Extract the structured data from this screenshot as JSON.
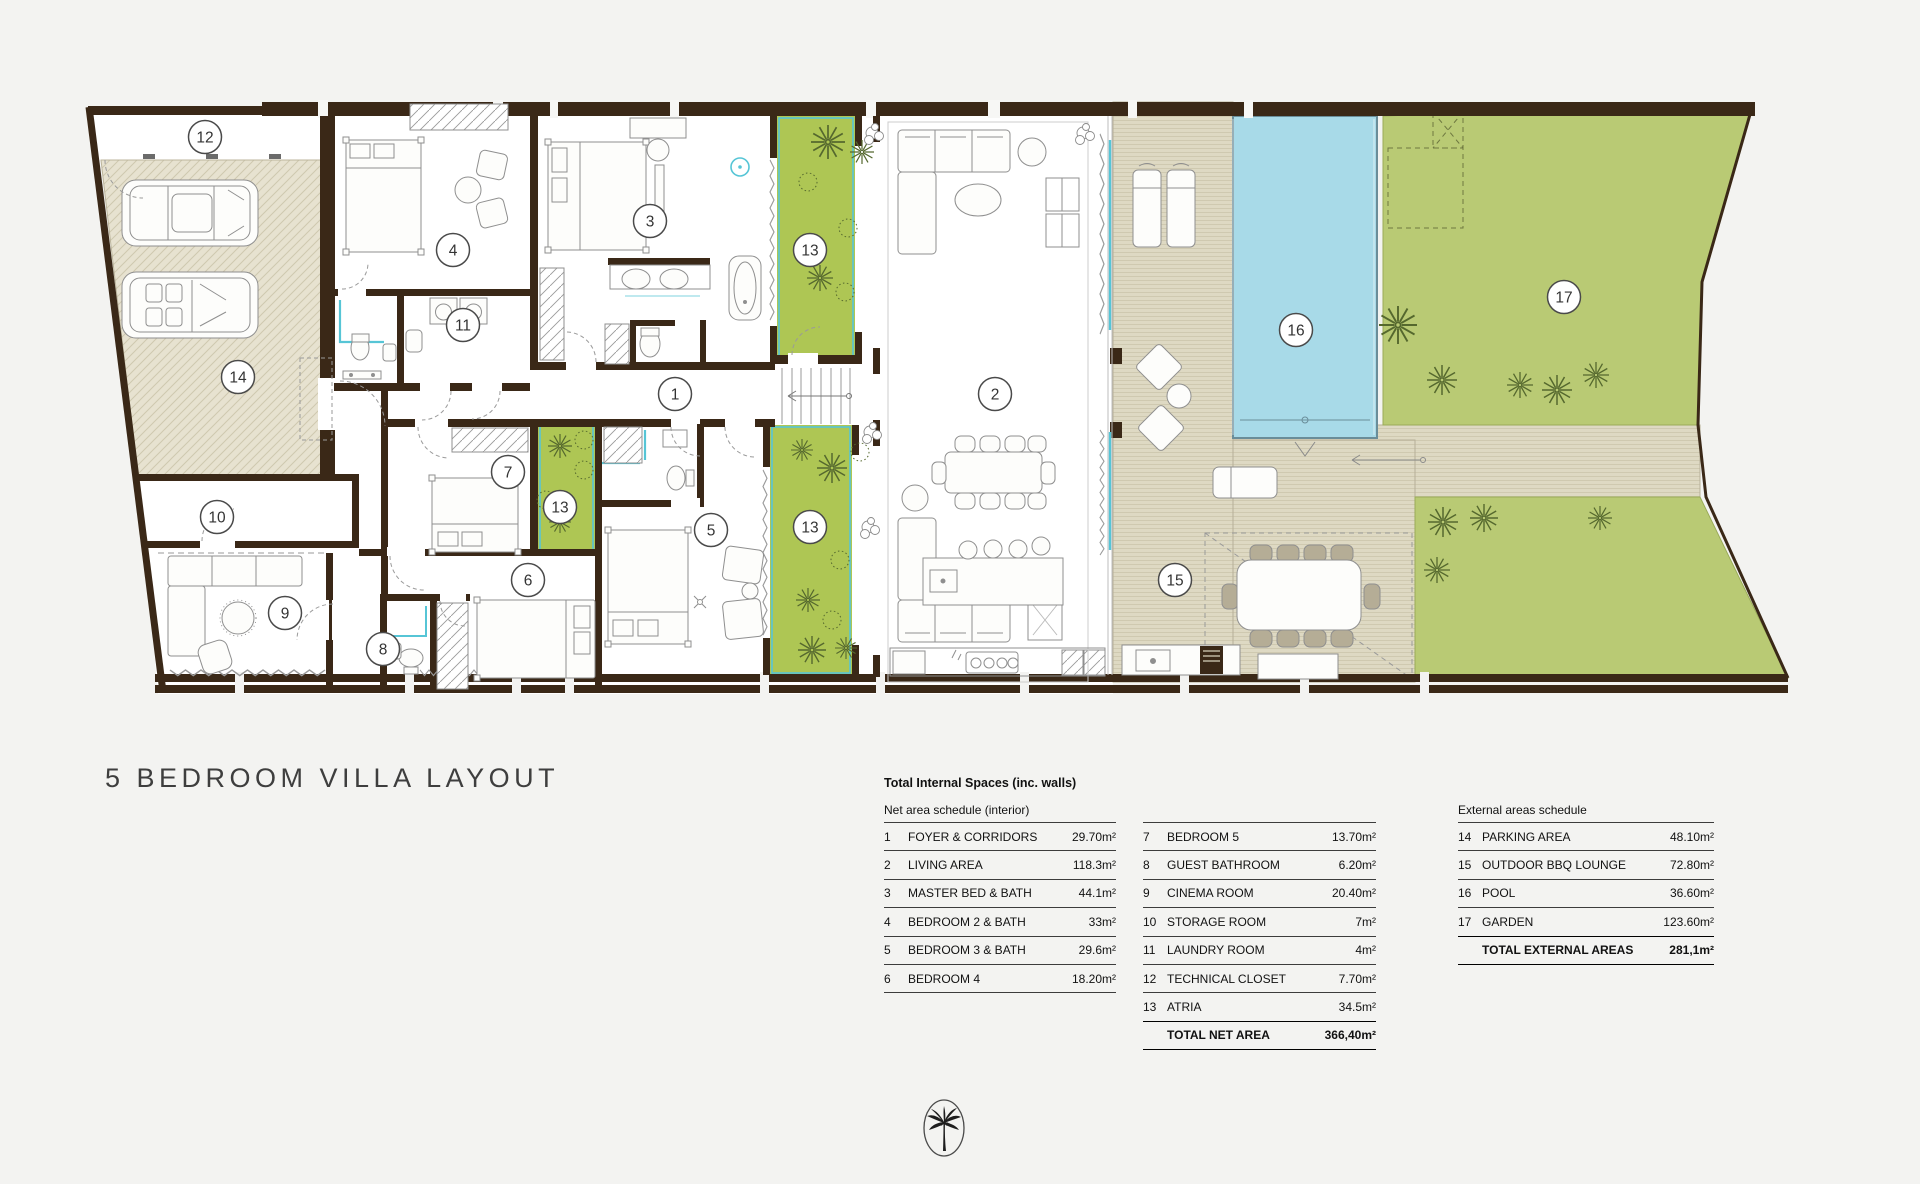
{
  "title": "5 BEDROOM VILLA LAYOUT",
  "logo": {
    "icon": "palm-tree-icon"
  },
  "colors": {
    "wall": "#3a2817",
    "atrium_green": "#aec654",
    "garden_green": "#b9ca74",
    "pool_blue": "#a8dae8",
    "deck_beige": "#ded9c3",
    "parking_beige": "#e7e2d0",
    "glass_teal": "#56c5d6",
    "background": "#f3f3f1"
  },
  "plan": {
    "labels": [
      {
        "n": "12",
        "x": 205,
        "y": 137
      },
      {
        "n": "14",
        "x": 238,
        "y": 377
      },
      {
        "n": "4",
        "x": 453,
        "y": 250
      },
      {
        "n": "11",
        "x": 463,
        "y": 325
      },
      {
        "n": "3",
        "x": 650,
        "y": 221
      },
      {
        "n": "13",
        "x": 810,
        "y": 250
      },
      {
        "n": "1",
        "x": 675,
        "y": 394
      },
      {
        "n": "2",
        "x": 995,
        "y": 394
      },
      {
        "n": "7",
        "x": 508,
        "y": 472
      },
      {
        "n": "13",
        "x": 560,
        "y": 507
      },
      {
        "n": "10",
        "x": 217,
        "y": 517
      },
      {
        "n": "5",
        "x": 711,
        "y": 530
      },
      {
        "n": "13",
        "x": 810,
        "y": 527
      },
      {
        "n": "6",
        "x": 528,
        "y": 580
      },
      {
        "n": "9",
        "x": 285,
        "y": 613
      },
      {
        "n": "8",
        "x": 383,
        "y": 649
      },
      {
        "n": "15",
        "x": 1175,
        "y": 580
      },
      {
        "n": "16",
        "x": 1296,
        "y": 330
      },
      {
        "n": "17",
        "x": 1564,
        "y": 297
      }
    ]
  },
  "schedules": {
    "internal_title": "Total Internal Spaces (inc. walls)",
    "net": {
      "title": "Net area schedule (interior)",
      "left_rows": [
        {
          "num": "1",
          "label": "FOYER & CORRIDORS",
          "value": "29.70m²"
        },
        {
          "num": "2",
          "label": "LIVING AREA",
          "value": "118.3m²"
        },
        {
          "num": "3",
          "label": "MASTER BED & BATH",
          "value": "44.1m²"
        },
        {
          "num": "4",
          "label": "BEDROOM 2 & BATH",
          "value": "33m²"
        },
        {
          "num": "5",
          "label": "BEDROOM 3 & BATH",
          "value": "29.6m²"
        },
        {
          "num": "6",
          "label": "BEDROOM 4",
          "value": "18.20m²"
        }
      ],
      "right_rows": [
        {
          "num": "7",
          "label": "BEDROOM 5",
          "value": "13.70m²"
        },
        {
          "num": "8",
          "label": "GUEST BATHROOM",
          "value": "6.20m²"
        },
        {
          "num": "9",
          "label": "CINEMA ROOM",
          "value": "20.40m²"
        },
        {
          "num": "10",
          "label": "STORAGE ROOM",
          "value": "7m²"
        },
        {
          "num": "11",
          "label": "LAUNDRY ROOM",
          "value": "4m²"
        },
        {
          "num": "12",
          "label": "TECHNICAL CLOSET",
          "value": "7.70m²"
        },
        {
          "num": "13",
          "label": "ATRIA",
          "value": "34.5m²"
        }
      ],
      "total_label": "TOTAL NET AREA",
      "total_value": "366,40m²"
    },
    "external": {
      "title": "External areas schedule",
      "rows": [
        {
          "num": "14",
          "label": "PARKING AREA",
          "value": "48.10m²"
        },
        {
          "num": "15",
          "label": "OUTDOOR BBQ LOUNGE",
          "value": "72.80m²"
        },
        {
          "num": "16",
          "label": "POOL",
          "value": "36.60m²"
        },
        {
          "num": "17",
          "label": "GARDEN",
          "value": "123.60m²"
        }
      ],
      "total_label": "TOTAL EXTERNAL AREAS",
      "total_value": "281,1m²"
    }
  }
}
